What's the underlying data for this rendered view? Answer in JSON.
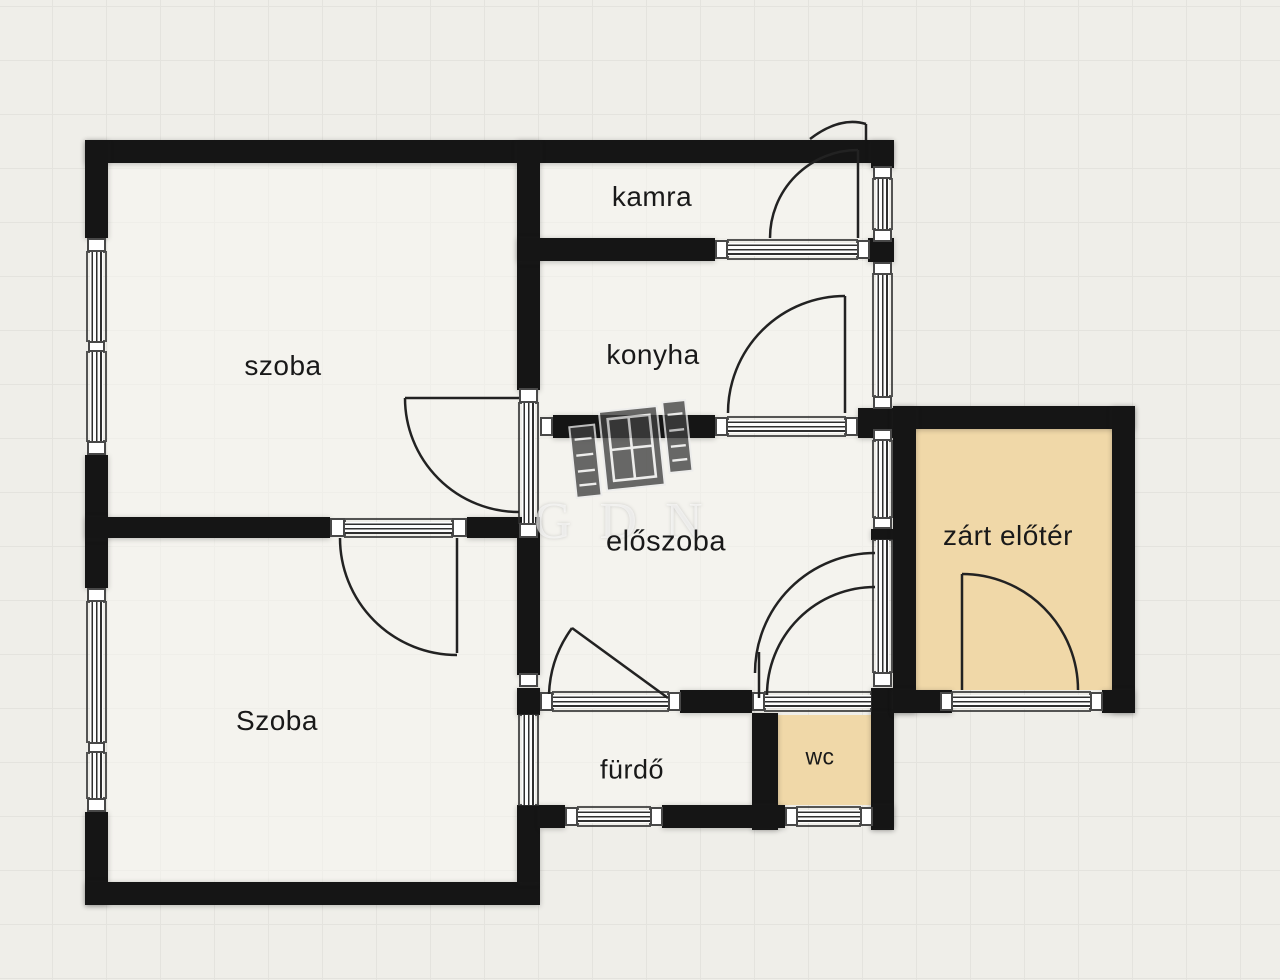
{
  "plan": {
    "watermark_text": "GDN",
    "rooms": [
      {
        "id": "szoba-top",
        "label": "szoba"
      },
      {
        "id": "kamra",
        "label": "kamra"
      },
      {
        "id": "konyha",
        "label": "konyha"
      },
      {
        "id": "eloszoba",
        "label": "előszoba"
      },
      {
        "id": "szoba-bottom",
        "label": "Szoba"
      },
      {
        "id": "furdo",
        "label": "fürdő"
      },
      {
        "id": "wc",
        "label": "wc"
      },
      {
        "id": "zart-eloter",
        "label": "zárt előtér"
      }
    ],
    "colors": {
      "background": "#efeee9",
      "grid_line": "#e4e3de",
      "wall": "#151515",
      "room_light": "#f5f4f0",
      "room_accent": "#f0d8a8",
      "door_stroke": "#222222"
    }
  }
}
